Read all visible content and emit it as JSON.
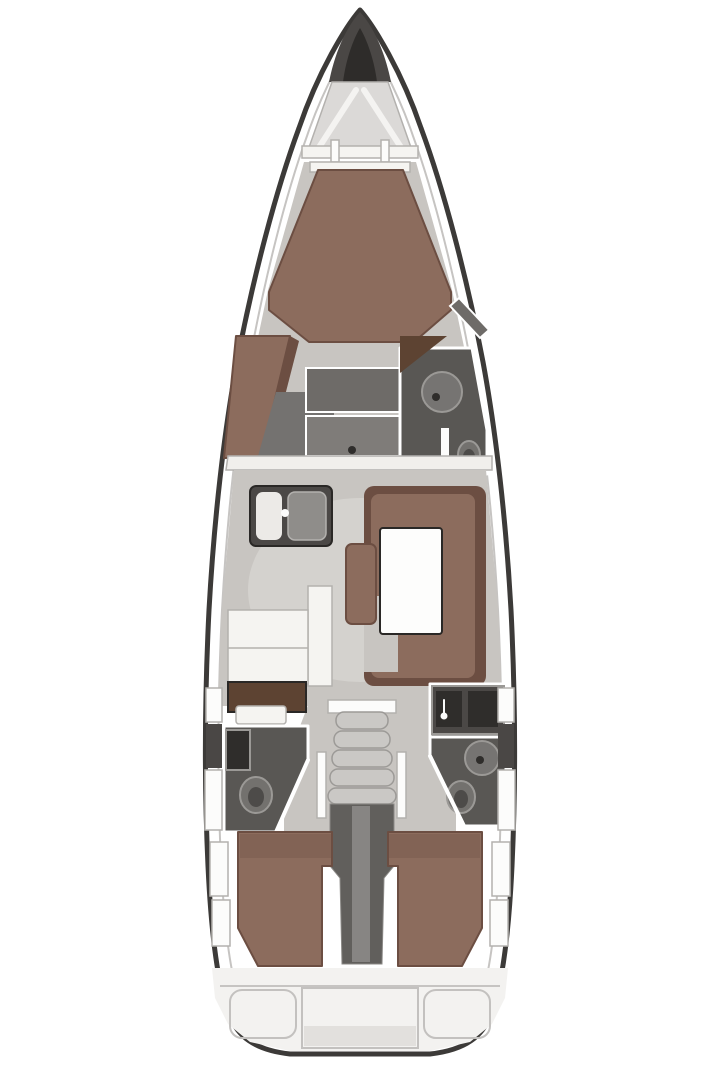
{
  "plan": {
    "description": "Top-down interior layout plan of a sailing yacht: bow anchor locker, forward owner cabin with island berth and en-suite head, salon with galley to port and U-shaped settee with table to starboard, two aft heads, companionway steps over engine compartment, two aft double cabins, stern transom lockers"
  },
  "palette": {
    "hull_fill": "#ffffff",
    "bow_dark": "#4a4745",
    "bow_core": "#2e2c2a",
    "locker_fill": "#dbd9d7",
    "floor": "#c8c5c1",
    "floor_light": "#d8d5d1",
    "upholstery": "#8c6c5d",
    "upholstery_dark": "#6c4e42",
    "wood": "#5d4332",
    "counter_dark": "#4b4846",
    "basin_white": "#eceae7",
    "drainboard": "#8f8d8a",
    "fixture_white": "#f5f4f1",
    "furniture_gray": "#6e6b68",
    "furniture_gray_light": "#7f7c79",
    "dressing_gray": "#747270",
    "head_floor": "#595754",
    "shower_gray": "#767472",
    "toilet_gray": "#73716e",
    "toilet_inner": "#4d4b49",
    "dark_panel": "#2f2d2b",
    "bulkhead": "#f1efec",
    "table_white": "#fdfdfc",
    "steps": "#cac8c5",
    "rail_white": "#fcfcfb",
    "engine": "#615f5c",
    "engine_stripe": "#8e8c89",
    "transom": "#f3f2f0",
    "bench_white": "#fafaf8",
    "shade": "#e2e0dd"
  }
}
